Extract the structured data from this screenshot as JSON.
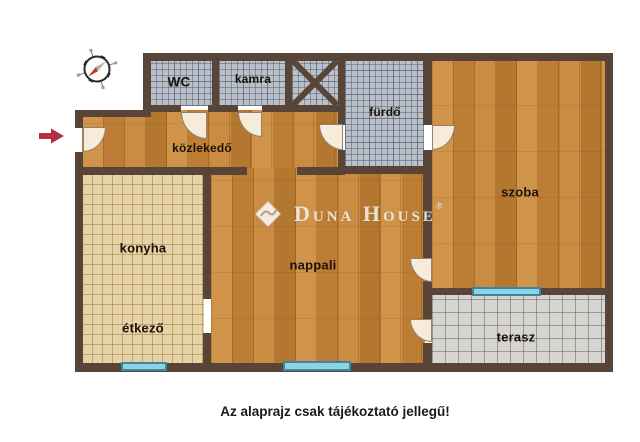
{
  "colors": {
    "wall": "#584538",
    "wood_base": "#c4863e",
    "kitchen_tile": "#e7d3a6",
    "bath_tile": "#b9c0ca",
    "terrace_tile": "#d7d5d2",
    "window_blue": "#8ed2e6",
    "window_border": "#3e86a0",
    "door_fill": "#f7ecd9",
    "label": "#1c1208",
    "arrow_red": "#b23049"
  },
  "rooms": {
    "wc": "WC",
    "kamra": "kamra",
    "furdo": "fürdő",
    "kozlekedo": "közlekedő",
    "konyha": "konyha",
    "etkezo": "étkező",
    "nappali": "nappali",
    "szoba": "szoba",
    "terasz": "terasz"
  },
  "watermark": {
    "brand": "Duna House",
    "registered": "®"
  },
  "footer": {
    "disclaimer": "Az alaprajz csak tájékoztató jellegű!"
  },
  "icons": {
    "compass": "compass-rose-icon",
    "entrance_arrow": "entrance-arrow-icon",
    "shaft_cross": "shaft-cross-icon",
    "logo_diamond": "dunahouse-diamond-icon"
  }
}
